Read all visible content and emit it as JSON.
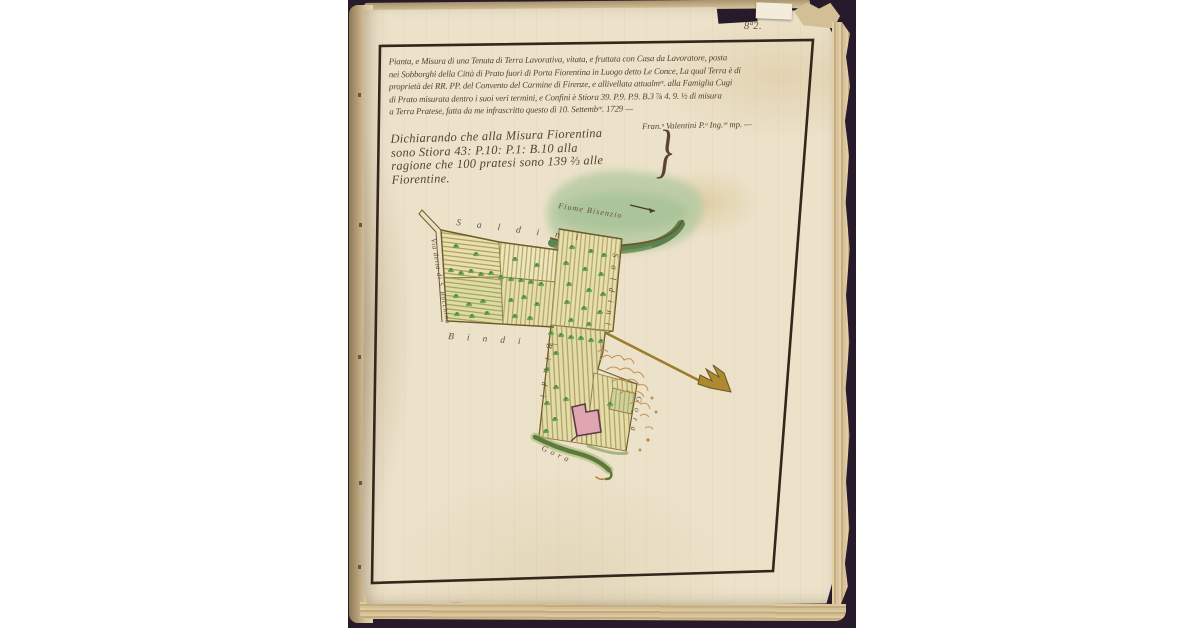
{
  "page": {
    "folio_number": "8ª2.",
    "title_lines": [
      "Pianta, e Misura di una Tenuta di Terra Lavorativa, vitata, e fruttata con Casa da Lavoratore, posta",
      "nei Sobborghi della Città di Prato fuori di Porta Fiorentina in Luogo detto Le Conce, La qual Terra è di",
      "proprietà dei RR. PP. del Convento del Carmine di Firenze, e allivellata attualmᵗᵉ. alla Famiglia Cugi",
      "di Prato misurata dentro i suoi veri termini, e Confini è Stiora 39. P.9. P.9. B.3 ⅞ 4. 9. ½  di misura",
      "a Terra Pratese, fatta da me infrascritto questo dì 10. Settembʳᵉ. 1729 —"
    ],
    "signature": "Fran.ᵒ Valentini P.ᵒ Ing.ʳᵉ mp. —",
    "declaration_lines": [
      "Dichiarando che alla Misura Fiorentina",
      "sono Stiora 43: P.10: P.1: B.10 alla",
      "ragione che 100 pratesi sono 139 ⅔ alle",
      "Fiorentine."
    ],
    "brace": "}"
  },
  "map": {
    "river_label": "Fiume Bisenzio",
    "road_label": "Via detta di S. Rocchino",
    "boundary_top": "Saldini",
    "boundary_right": "Saldini",
    "boundary_arm_bottom": "Bindi —",
    "boundary_strip_left": "Bindi",
    "boundary_bottom_left": "Gora",
    "boundary_bottom_right": "Gora"
  },
  "colors": {
    "photo_background": "#261a2b",
    "paper": "#ece2ca",
    "ink": "#57422f",
    "frame": "#33261b",
    "field_yellow": "#e9e0ab",
    "field_green": "#dcdda3",
    "stripe": "#ada063",
    "tree_green": "#5e9447",
    "river_wash": "#b7cba3",
    "river_band": "#4e7a44",
    "house_pink": "#dfa5b1",
    "straw": "#c18c4c",
    "arrow_gold": "#9d7d2d"
  }
}
